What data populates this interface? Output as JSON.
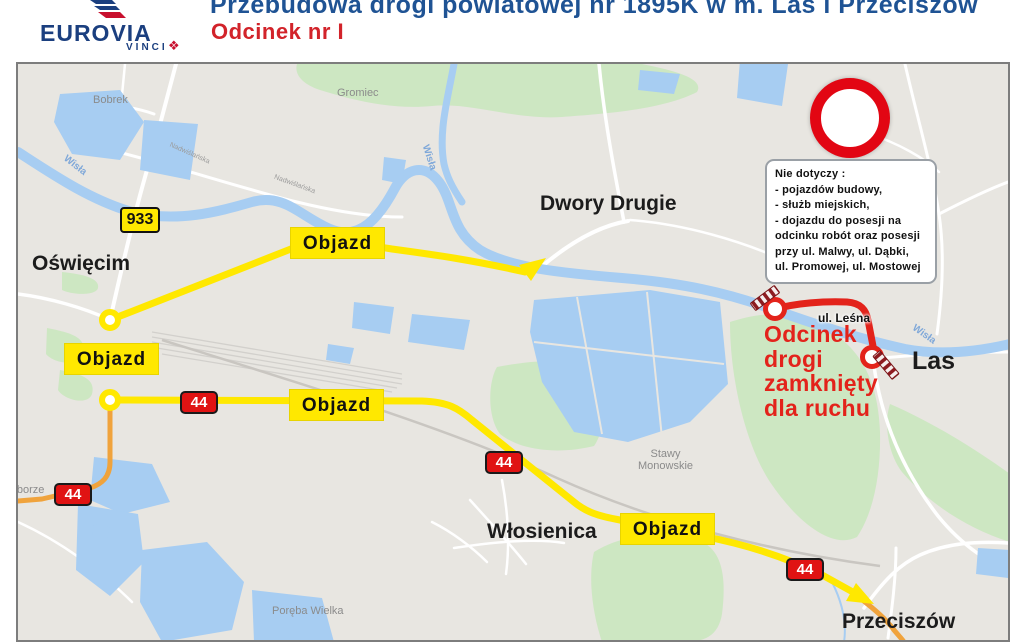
{
  "header": {
    "logo": {
      "brand": "EUROVIA",
      "sub_brand": "VINCI"
    },
    "title_line1": "Przebudowa drogi powiatowej nr 1895K w m. Las i Przeciszów",
    "title_line2": "Odcinek nr I"
  },
  "map": {
    "towns": {
      "oswiecim": "Oświęcim",
      "dwory_drugie": "Dwory Drugie",
      "wlosienica": "Włosienica",
      "las": "Las",
      "przeciszow": "Przeciszów",
      "bobrek": "Bobrek",
      "gromiec": "Gromiec",
      "zaborze": "Zaborze",
      "poreba_wielka": "Poręba Wielka",
      "stawy_line1": "Stawy",
      "stawy_line2": "Monowskie"
    },
    "rivers": {
      "wisla": "Wisła"
    },
    "streets": {
      "lesna": "ul. Leśna",
      "nadwislanska": "Nadwiślańska"
    },
    "detour_label": "Objazd",
    "badges": {
      "regional": "933",
      "national": "44"
    },
    "closed_text_lines": [
      "Odcinek",
      "drogi",
      "zamknięty",
      "dla ruchu"
    ],
    "note": {
      "title": "Nie dotyczy :",
      "lines": [
        "- pojazdów budowy,",
        "- służb miejskich,",
        "- dojazdu do posesji na",
        "odcinku robót oraz posesji",
        "przy ul. Malwy, ul. Dąbki,",
        "ul. Promowej, ul. Mostowej"
      ]
    },
    "colors": {
      "detour_yellow": "#ffe800",
      "closed_red": "#e3231b",
      "badge_red": "#e01313",
      "title_blue": "#1f5394",
      "title_red": "#d2232a",
      "water_blue": "#a7cdf2",
      "green_area": "#cde7c2",
      "highway_orange": "#f0a33c"
    }
  }
}
